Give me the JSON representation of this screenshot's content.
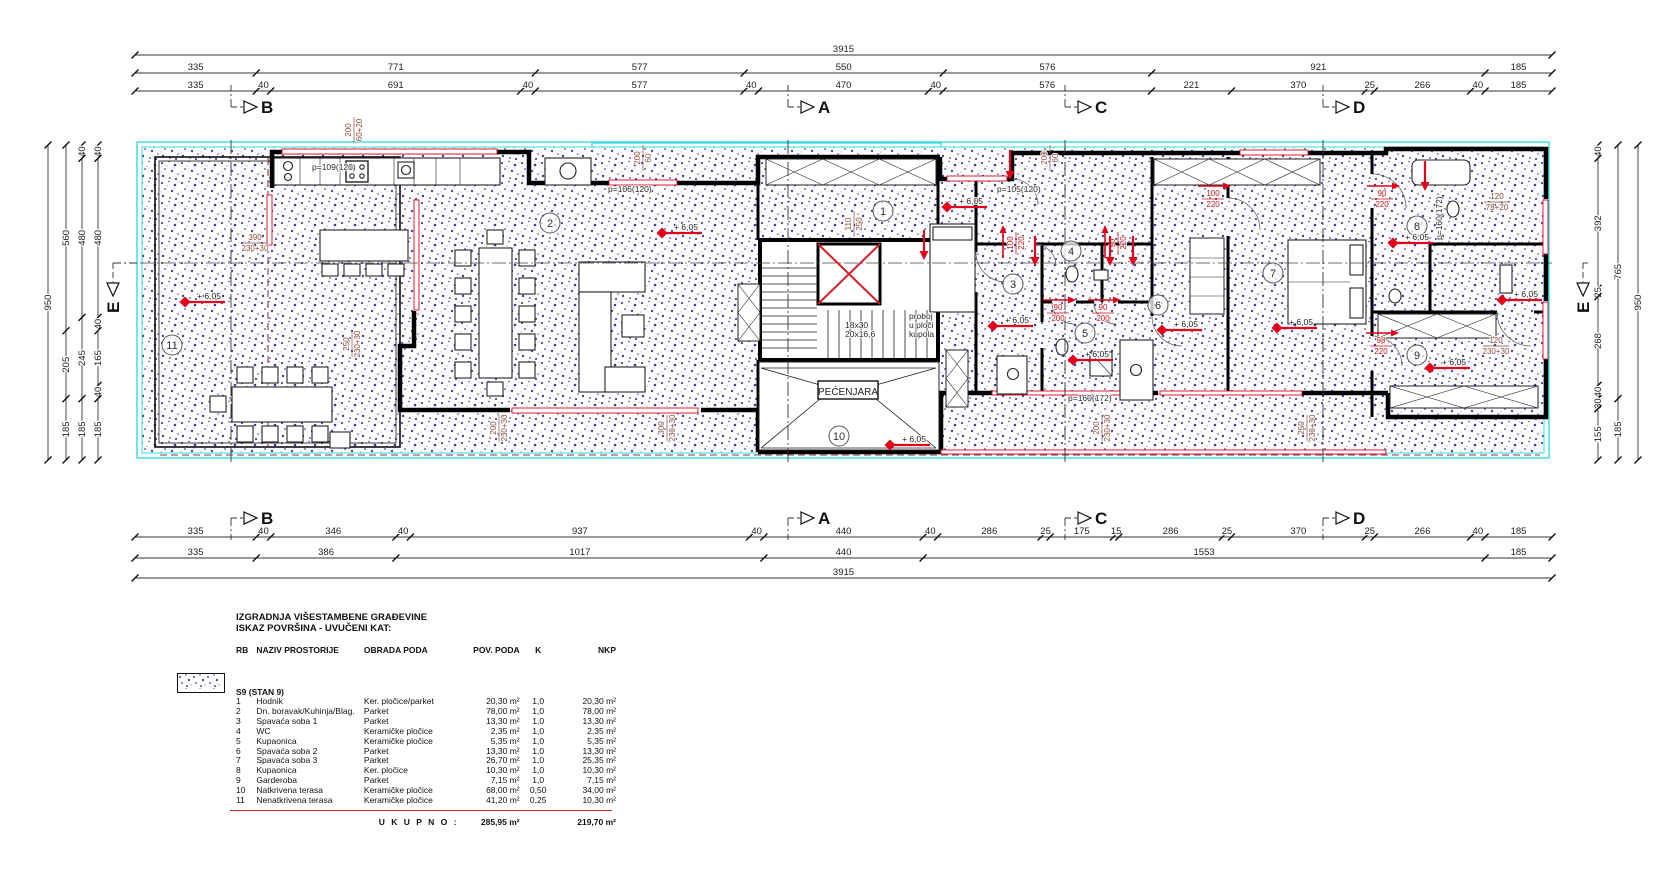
{
  "colors": {
    "cyan": "#35dce2",
    "red": "#e2001a",
    "maroon": "#8d4a3c",
    "stipple": "#4343a5",
    "wall": "#000000"
  },
  "dims": {
    "top": [
      {
        "pos": 55,
        "segs": [
          "3915"
        ]
      },
      {
        "pos": 73,
        "segs": [
          "335",
          "771",
          "577",
          "550",
          "576",
          "921",
          "185"
        ]
      },
      {
        "pos": 91,
        "segs": [
          "335",
          "40",
          "691",
          "40",
          "577",
          "40",
          "470",
          "40",
          "576",
          "221",
          "370",
          "25",
          "266",
          "40",
          "185"
        ]
      }
    ],
    "bottom": [
      {
        "pos": 537,
        "segs": [
          "335",
          "40",
          "346",
          "40",
          "937",
          "40",
          "440",
          "40",
          "286",
          "25",
          "175",
          "15",
          "286",
          "25",
          "370",
          "25",
          "266",
          "40",
          "185"
        ]
      },
      {
        "pos": 558,
        "segs": [
          "335",
          "386",
          "1017",
          "440",
          "1553",
          "185"
        ]
      },
      {
        "pos": 578,
        "segs": [
          "3915"
        ]
      }
    ],
    "left": [
      {
        "pos": 48,
        "segs": [
          "950"
        ]
      },
      {
        "pos": 66,
        "segs": [
          "560",
          "205",
          "185"
        ]
      },
      {
        "pos": 82,
        "segs": [
          "40",
          "480",
          "245",
          "185"
        ]
      },
      {
        "pos": 98,
        "segs": [
          "40",
          "480",
          "40",
          "165",
          "40",
          "185"
        ]
      }
    ],
    "right": [
      {
        "pos": 1598,
        "segs": [
          "40",
          "392",
          "25",
          "268",
          "40",
          "30",
          "155"
        ]
      },
      {
        "pos": 1618,
        "segs": [
          "765",
          "185"
        ]
      },
      {
        "pos": 1638,
        "segs": [
          "950"
        ]
      }
    ]
  },
  "plan": {
    "sections": [
      {
        "letter": "B",
        "x": 231
      },
      {
        "letter": "A",
        "x": 788
      },
      {
        "letter": "C",
        "x": 1065
      },
      {
        "letter": "D",
        "x": 1323
      }
    ],
    "side_section": {
      "letter": "E"
    },
    "rooms": [
      {
        "n": "1",
        "x": 883,
        "y": 211
      },
      {
        "n": "2",
        "x": 550,
        "y": 223
      },
      {
        "n": "3",
        "x": 1013,
        "y": 284
      },
      {
        "n": "4",
        "x": 1071,
        "y": 251
      },
      {
        "n": "5",
        "x": 1085,
        "y": 333
      },
      {
        "n": "6",
        "x": 1158,
        "y": 305
      },
      {
        "n": "7",
        "x": 1273,
        "y": 273
      },
      {
        "n": "8",
        "x": 1417,
        "y": 226
      },
      {
        "n": "9",
        "x": 1417,
        "y": 355
      },
      {
        "n": "10",
        "x": 839,
        "y": 436
      },
      {
        "n": "11",
        "x": 172,
        "y": 345
      }
    ],
    "level_label": "+ 6,05",
    "levels": [
      {
        "x": 185,
        "y": 302
      },
      {
        "x": 662,
        "y": 233
      },
      {
        "x": 947,
        "y": 207
      },
      {
        "x": 993,
        "y": 326
      },
      {
        "x": 1073,
        "y": 360
      },
      {
        "x": 1162,
        "y": 330
      },
      {
        "x": 1277,
        "y": 328
      },
      {
        "x": 1393,
        "y": 243
      },
      {
        "x": 1430,
        "y": 368
      },
      {
        "x": 890,
        "y": 445
      },
      {
        "x": 1502,
        "y": 300
      }
    ],
    "door_labels": [
      {
        "x": 1213,
        "y": 198,
        "a": "100",
        "b": "220"
      },
      {
        "x": 1382,
        "y": 198,
        "a": "90",
        "b": "220"
      },
      {
        "x": 1381,
        "y": 345,
        "a": "98",
        "b": "220"
      },
      {
        "x": 1058,
        "y": 312,
        "a": "90",
        "b": "200"
      },
      {
        "x": 1103,
        "y": 312,
        "a": "90",
        "b": "200"
      },
      {
        "x": 1015,
        "y": 243,
        "a": "100",
        "b": "220",
        "rot": 1
      },
      {
        "x": 1117,
        "y": 243,
        "a": "90",
        "b": "220",
        "rot": 1
      }
    ],
    "win_labels": [
      {
        "x": 255,
        "y": 241,
        "a": "390",
        "b": "230+30"
      },
      {
        "x": 352,
        "y": 130,
        "a": "200",
        "b": "60+20",
        "rot": 1
      },
      {
        "x": 641,
        "y": 158,
        "a": "200",
        "b": "60",
        "rot": 1
      },
      {
        "x": 1048,
        "y": 158,
        "a": "200",
        "b": "60",
        "rot": 1
      },
      {
        "x": 350,
        "y": 344,
        "a": "250",
        "b": "230+30",
        "rot": 1
      },
      {
        "x": 497,
        "y": 428,
        "a": "200",
        "b": "230+30",
        "rot": 1
      },
      {
        "x": 665,
        "y": 428,
        "a": "300",
        "b": "230+30",
        "rot": 1
      },
      {
        "x": 1100,
        "y": 428,
        "a": "200",
        "b": "230+30",
        "rot": 1
      },
      {
        "x": 1305,
        "y": 428,
        "a": "250",
        "b": "230+30",
        "rot": 1
      },
      {
        "x": 1497,
        "y": 200,
        "a": "120",
        "b": "78+20"
      },
      {
        "x": 1496,
        "y": 344,
        "a": "120",
        "b": "230+30"
      },
      {
        "x": 852,
        "y": 224,
        "a": "110",
        "b": "250",
        "rot": 1
      }
    ],
    "texts": [
      {
        "x": 312,
        "y": 170,
        "t": "p=109(120)"
      },
      {
        "x": 608,
        "y": 192,
        "t": "p=106(120)"
      },
      {
        "x": 997,
        "y": 192,
        "t": "p=105(120)"
      },
      {
        "x": 1068,
        "y": 401,
        "t": "p=160(172)"
      },
      {
        "x": 1442,
        "y": 240,
        "t": "p=160(172)",
        "rot": 1
      },
      {
        "x": 845,
        "y": 328,
        "t": "18x30"
      },
      {
        "x": 845,
        "y": 337,
        "t": "20x16,6"
      },
      {
        "x": 909,
        "y": 319,
        "t": "proboj"
      },
      {
        "x": 909,
        "y": 328,
        "t": "u ploči"
      },
      {
        "x": 909,
        "y": 337,
        "t": "kupola"
      }
    ],
    "pecenjara": {
      "x": 848,
      "y": 392,
      "t": "PEĆENJARA"
    }
  },
  "table": {
    "title1": "IZGRADNJA VIŠESTAMBENE GRAĐEVINE",
    "title2": "ISKAZ POVRŠINA - UVUČENI KAT:",
    "columns": [
      "RB",
      "NAZIV PROSTORIJE",
      "OBRADA PODA",
      "POV. PODA",
      "K",
      "NKP"
    ],
    "group": "S9 (STAN 9)",
    "rows": [
      [
        "1",
        "Hodnik",
        "Ker. pločice/parket",
        "20,30 m²",
        "1,0",
        "20,30 m²"
      ],
      [
        "2",
        "Dn. boravak/Kuhinja/Blag.",
        "Parket",
        "78,00 m²",
        "1,0",
        "78,00 m²"
      ],
      [
        "3",
        "Spavaća soba 1",
        "Parket",
        "13,30 m²",
        "1,0",
        "13,30 m²"
      ],
      [
        "4",
        "WC",
        "Keramičke pločice",
        "2,35 m²",
        "1,0",
        "2,35 m²"
      ],
      [
        "5",
        "Kupaonica",
        "Keramičke pločice",
        "5,35 m²",
        "1,0",
        "5,35 m²"
      ],
      [
        "6",
        "Spavaća soba 2",
        "Parket",
        "13,30 m²",
        "1,0",
        "13,30 m²"
      ],
      [
        "7",
        "Spavaća soba 3",
        "Parket",
        "26,70 m²",
        "1,0",
        "25,35 m²"
      ],
      [
        "8",
        "Kupaonica",
        "Ker. pločice",
        "10,30 m²",
        "1,0",
        "10,30 m²"
      ],
      [
        "9",
        "Garderoba",
        "Parket",
        "7,15 m²",
        "1,0",
        "7,15 m²"
      ],
      [
        "10",
        "Natkrivena terasa",
        "Keramičke pločice",
        "68,00 m²",
        "0,50",
        "34,00 m²"
      ],
      [
        "11",
        "Nenatkrivena terasa",
        "Keramičke pločice",
        "41,20 m²",
        "0,25",
        "10,30 m²"
      ]
    ],
    "total_label": "U K U P N O :",
    "total_pov": "285,95 m²",
    "total_nkp": "219,70 m²"
  }
}
